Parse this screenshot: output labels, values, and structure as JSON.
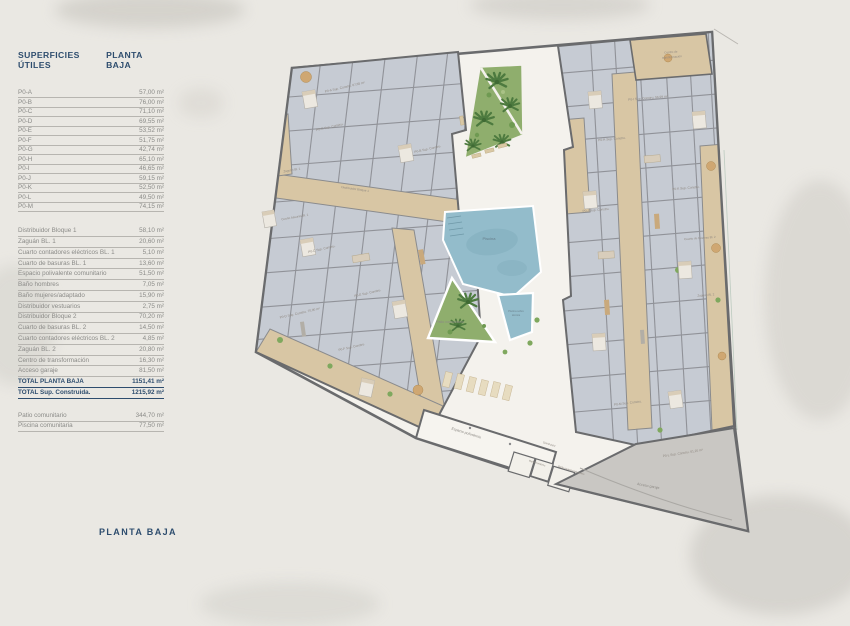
{
  "panel": {
    "header": {
      "col1": "SUPERFICIES ÚTILES",
      "col2": "PLANTA BAJA"
    },
    "table1": {
      "rows": [
        {
          "label": "P0-A",
          "value": "57,00 m²"
        },
        {
          "label": "P0-B",
          "value": "76,00 m²"
        },
        {
          "label": "P0-C",
          "value": "71,10 m²"
        },
        {
          "label": "P0-D",
          "value": "69,55 m²"
        },
        {
          "label": "P0-E",
          "value": "53,52 m²"
        },
        {
          "label": "P0-F",
          "value": "51,75 m²"
        },
        {
          "label": "P0-G",
          "value": "42,74 m²"
        },
        {
          "label": "P0-H",
          "value": "65,10 m²"
        },
        {
          "label": "P0-I",
          "value": "46,65 m²"
        },
        {
          "label": "P0-J",
          "value": "59,15 m²"
        },
        {
          "label": "P0-K",
          "value": "52,50 m²"
        },
        {
          "label": "P0-L",
          "value": "49,50 m²"
        },
        {
          "label": "P0-M",
          "value": "74,15 m²"
        }
      ]
    },
    "table2": {
      "rows": [
        {
          "label": "Distribuidor Bloque 1",
          "value": "58,10 m²"
        },
        {
          "label": "Zaguán BL. 1",
          "value": "20,60 m²"
        },
        {
          "label": "Cuarto contadores eléctricos BL. 1",
          "value": "5,10 m²"
        },
        {
          "label": "Cuarto de basuras BL. 1",
          "value": "13,60 m²"
        },
        {
          "label": "Espacio polivalente comunitario",
          "value": "51,50 m²"
        },
        {
          "label": "Baño hombres",
          "value": "7,05 m²"
        },
        {
          "label": "Baño mujeres/adaptado",
          "value": "15,90 m²"
        },
        {
          "label": "Distribuidor vestuarios",
          "value": "2,75 m²"
        },
        {
          "label": "Distribuidor Bloque 2",
          "value": "70,20 m²"
        },
        {
          "label": "Cuarto de basuras BL. 2",
          "value": "14,50 m²"
        },
        {
          "label": "Cuarto contadores eléctricos BL. 2",
          "value": "4,85 m²"
        },
        {
          "label": "Zaguán BL. 2",
          "value": "20,80 m²"
        },
        {
          "label": "Centro de transformación",
          "value": "16,30 m²"
        },
        {
          "label": "Acceso garaje",
          "value": "81,50 m²"
        },
        {
          "label": "TOTAL PLANTA BAJA",
          "value": "1151,41 m²",
          "cls": "total"
        },
        {
          "label": "TOTAL Sup. Construida.",
          "value": "1215,92 m²",
          "cls": "total"
        }
      ]
    },
    "table3": {
      "rows": [
        {
          "label": "Patio comunitario",
          "value": "344,70 m²"
        },
        {
          "label": "Piscina comunitaria",
          "value": "77,50 m²"
        }
      ]
    },
    "footer_title": "PLANTA BAJA"
  },
  "plan": {
    "units": [
      "P0-A Sup. Constru. 67,65 m²",
      "P0-B Sup. Constru.",
      "P0-C Sup. Constru.",
      "P0-D Sup. Constru. 70,00 m²",
      "P0-E Sup. Constru.",
      "P0-F Sup. Constru.",
      "P0-G Sup. Constru.",
      "P0-H Sup. Constru.",
      "P0-I Sup. Constru. 56,99 m²",
      "P0-J Sup. Constru.",
      "P0-K Sup. Constru.",
      "P0-L Sup. Constru. 61,25 m²",
      "P0-M Sup. Constru."
    ],
    "rooms": {
      "zaguan1": "Zaguán Bl. 1",
      "distribuidor_b1": "Distribuidor Bloque 1",
      "basuras1": "Cuarto basuras Bl. 1",
      "centro_1": "Centro de",
      "centro_2": "transformación",
      "basuras2": "Cuarto de basuras Bl. 2",
      "zaguan2": "Zaguán Bl. 2",
      "piscina": "Piscina",
      "piscina_small_1": "Piscina sobre",
      "piscina_small_2": "técnica",
      "patio": "Patio comunitario",
      "espacio": "Espacio polivalente",
      "acceso": "Acceso garaje",
      "distribuidor": "Distribuidor",
      "bano_h": "Baño hombres",
      "bano_m": "Baño mujeres/adaptado"
    }
  },
  "colors": {
    "accent_navy": "#2e4d6e",
    "paper": "#eae8e3",
    "plan_ground": "#f4f2ed",
    "wall": "#6a6b6d",
    "room": "#c6cbd3",
    "corridor_tan": "#d8c6a4",
    "pool_blue": "#93bccb",
    "green": "#8fae6d",
    "palm_green": "#4d7a3f",
    "ramp_gray": "#c9c7c3"
  }
}
